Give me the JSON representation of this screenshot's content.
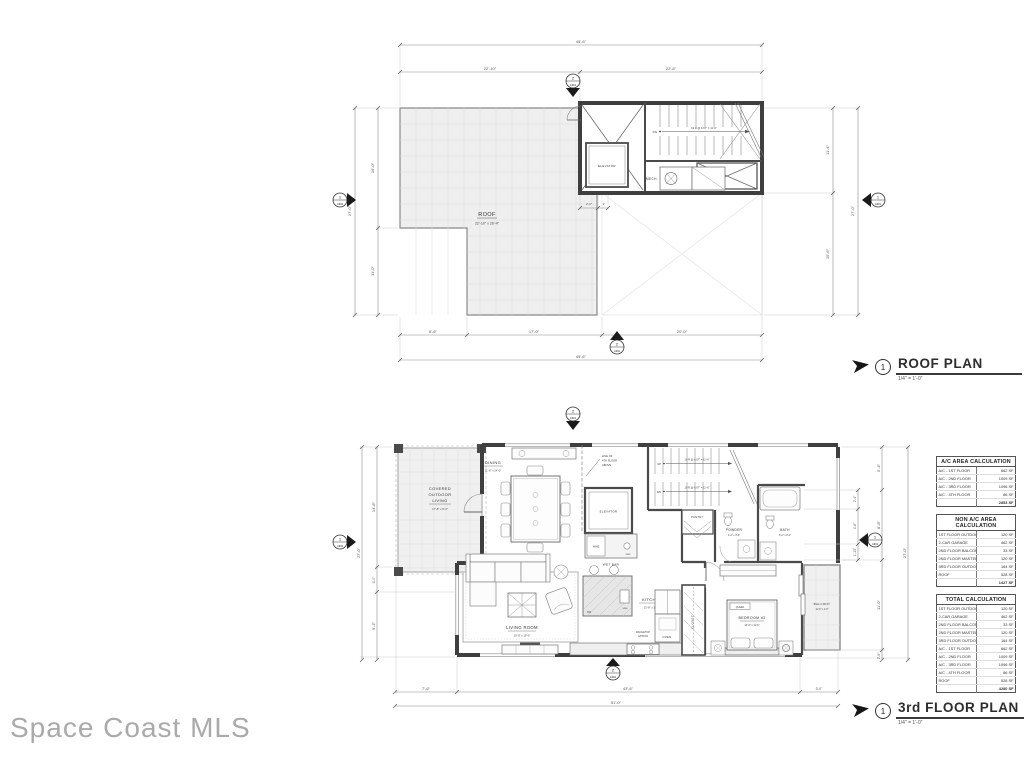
{
  "watermark": "Space Coast MLS",
  "titles": {
    "roof_title": {
      "number": "1",
      "label": "ROOF PLAN",
      "scale": "1/4\" = 1'-0\""
    },
    "third_title": {
      "number": "1",
      "label": "3rd FLOOR PLAN",
      "scale": "1/4\" = 1'-0\""
    }
  },
  "roof": {
    "room": "ROOF",
    "room_dim": "22'-10\" x 26'-4\"",
    "elevator": "ELEVATOR",
    "mech": "MECH.",
    "dn": "DN",
    "stair_note": "19 R @ 6.67\" = 11'-6\"",
    "dims": {
      "top_total": "45'-6\"",
      "top_left": "22'-10\"",
      "top_right": "22'-8\"",
      "left_total": "27'-0\"",
      "left_upper": "16'-0\"",
      "left_lower": "11'-0\"",
      "right_upper": "11'-4\"",
      "right_lower": "15'-6\"",
      "right_total": "27'-0\"",
      "bottom_a": "8'-6\"",
      "bottom_b": "17'-0\"",
      "bottom_c": "20'-0\"",
      "bottom_total": "45'-6\"",
      "stair_w": "2'-0\"",
      "stair_w2": "9\""
    },
    "markers": {
      "top_num": "2",
      "top_sheet": "A301",
      "left_num": "1",
      "left_sheet": "A302",
      "right_num": "1",
      "right_sheet": "A301",
      "bottom_num": "2",
      "bottom_sheet": "A302"
    }
  },
  "third": {
    "rooms": {
      "covered_1": "COVERED",
      "covered_2": "OUTDOOR",
      "covered_3": "LIVING",
      "covered_dim": "17'-8\" x 9'-4\"",
      "dining": "DINING",
      "dining_dim": "11'-8\" x 14'-0\"",
      "living": "LIVING ROOM",
      "living_dim": "15'-8\" x 19'-0\"",
      "kitchen": "KITCHEN",
      "kitchen_dim": "13'-8\" x 10'-0\"",
      "bedroom": "BEDROOM #3",
      "bedroom_dim": "12'-6\" x 11'-6\"",
      "queen": "QUEEN",
      "bath": "BATH",
      "bath_dim": "5'-2\" x 8'-4\"",
      "powder": "POWDER",
      "powder_dim": "4'-2\" x 4'-6\"",
      "pantry": "PANTRY",
      "closet": "CLOSET",
      "balcony": "BALCONY",
      "balcony_dim": "11'-6\" x 4'-0\"",
      "elevator": "ELEVATOR",
      "wet_bar": "WET BAR",
      "wine": "WINE",
      "sink": "SINK",
      "dw": "DW",
      "oven": "OVEN",
      "rangetop_1": "RANGETOP",
      "rangetop_2": "w/HOOD",
      "line_of_1": "LINE OF",
      "line_of_2": "4TH FLOOR",
      "line_of_3": "ABOVE",
      "up": "UP",
      "dn": "DN",
      "stair_note": "19 R @ 6.67\" = 11'-6\""
    },
    "dims": {
      "left_total": "27'-0\"",
      "left_a": "14'-8\"",
      "left_b": "3'-0\"",
      "left_c": "9'-4\"",
      "right_total": "27'-0\"",
      "right_a": "5'-4\"",
      "right_b": "8'-8\"",
      "right_c": "11'-0\"",
      "right_d": "2'-0\"",
      "bath_a": "2'-4\"",
      "bath_b": "4'-6\"",
      "bath_c": "1'-10\"",
      "bottom_a": "7'-6\"",
      "bottom_b": "43'-6\"",
      "bottom_c": "3'-0\"",
      "bottom_total": "51'-0\""
    },
    "markers": {
      "top_num": "2",
      "top_sheet": "A301",
      "left_num": "1",
      "left_sheet": "A302",
      "right_num": "1",
      "right_sheet": "A301",
      "bottom_num": "2",
      "bottom_sheet": "A302"
    }
  },
  "tables": {
    "ac": {
      "title": "A/C AREA CALCULATION",
      "rows": [
        [
          "A/C - 1ST FLOOR",
          "662 SF"
        ],
        [
          "A/C - 2ND FLOOR",
          "1009 SF"
        ],
        [
          "A/C - 3RD FLOOR",
          "1096 SF"
        ],
        [
          "A/C - 4TH FLOOR",
          "86 SF"
        ]
      ],
      "total": "2853 SF"
    },
    "non_ac": {
      "title": "NON A/C AREA CALCULATION",
      "rows": [
        [
          "1ST FLOOR OUTDOOR LIVING",
          "120 SF"
        ],
        [
          "2-CAR GARAGE",
          "462 SF"
        ],
        [
          "2ND FLOOR BALCONY",
          "33 SF"
        ],
        [
          "2ND FLOOR MASTER TERRACE",
          "120 SF"
        ],
        [
          "3RD FLOOR OUTDOOR LIVING",
          "164 SF"
        ],
        [
          "ROOF",
          "528 SF"
        ]
      ],
      "total": "1427 SF"
    },
    "total": {
      "title": "TOTAL CALCULATION",
      "rows": [
        [
          "1ST FLOOR OUTDOOR LIVING",
          "120 SF"
        ],
        [
          "2-CAR GARAGE",
          "462 SF"
        ],
        [
          "2ND FLOOR BALCONY",
          "33 SF"
        ],
        [
          "2ND FLOOR MASTER TERRACE",
          "120 SF"
        ],
        [
          "3RD FLOOR OUTDOOR LIVING",
          "164 SF"
        ],
        [
          "A/C - 1ST FLOOR",
          "662 SF"
        ],
        [
          "A/C - 2ND FLOOR",
          "1009 SF"
        ],
        [
          "A/C - 3RD FLOOR",
          "1096 SF"
        ],
        [
          "A/C - 4TH FLOOR",
          "86 SF"
        ],
        [
          "ROOF",
          "528 SF"
        ]
      ],
      "total": "4280 SF"
    }
  }
}
